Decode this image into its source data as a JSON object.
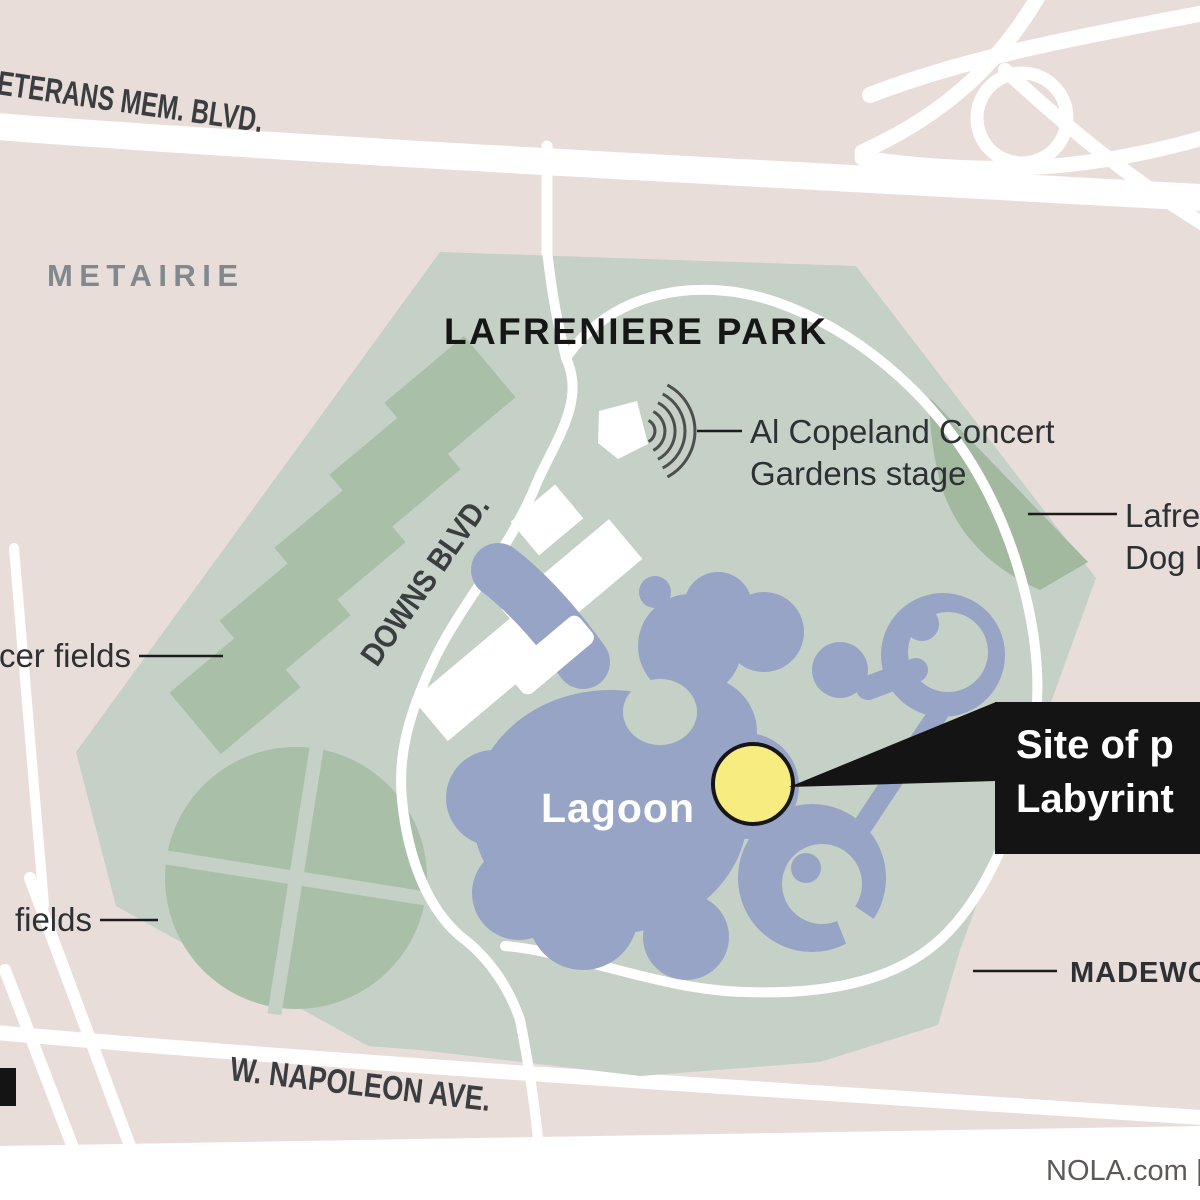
{
  "graphic": {
    "park_title": "LAFRENIERE PARK",
    "city_label": "METAIRIE",
    "credit": "NOLA.com | T"
  },
  "roads": {
    "veterans": "ETERANS MEM. BLVD.",
    "downs": "DOWNS BLVD.",
    "napoleon": "W. NAPOLEON AVE."
  },
  "water": {
    "lagoon": "Lagoon"
  },
  "callouts": {
    "stage_line1": "Al Copeland Concert",
    "stage_line2": "Gardens stage",
    "dog_line1": "Lafre",
    "dog_line2": "Dog P",
    "soccer_fields": "cer fields",
    "ball_fields": "fields",
    "madewood": "MADEWO",
    "site_line1": "Site of p",
    "site_line2": "Labyrint"
  },
  "colors": {
    "background": "#e9ddd9",
    "road": "#ffffff",
    "park": "#c5d0c6",
    "field": "#a9bfa8",
    "dog_park": "#a2b9a0",
    "lagoon": "#98a4c6",
    "marker": "#f7ec7f",
    "callout_box": "#141414"
  }
}
